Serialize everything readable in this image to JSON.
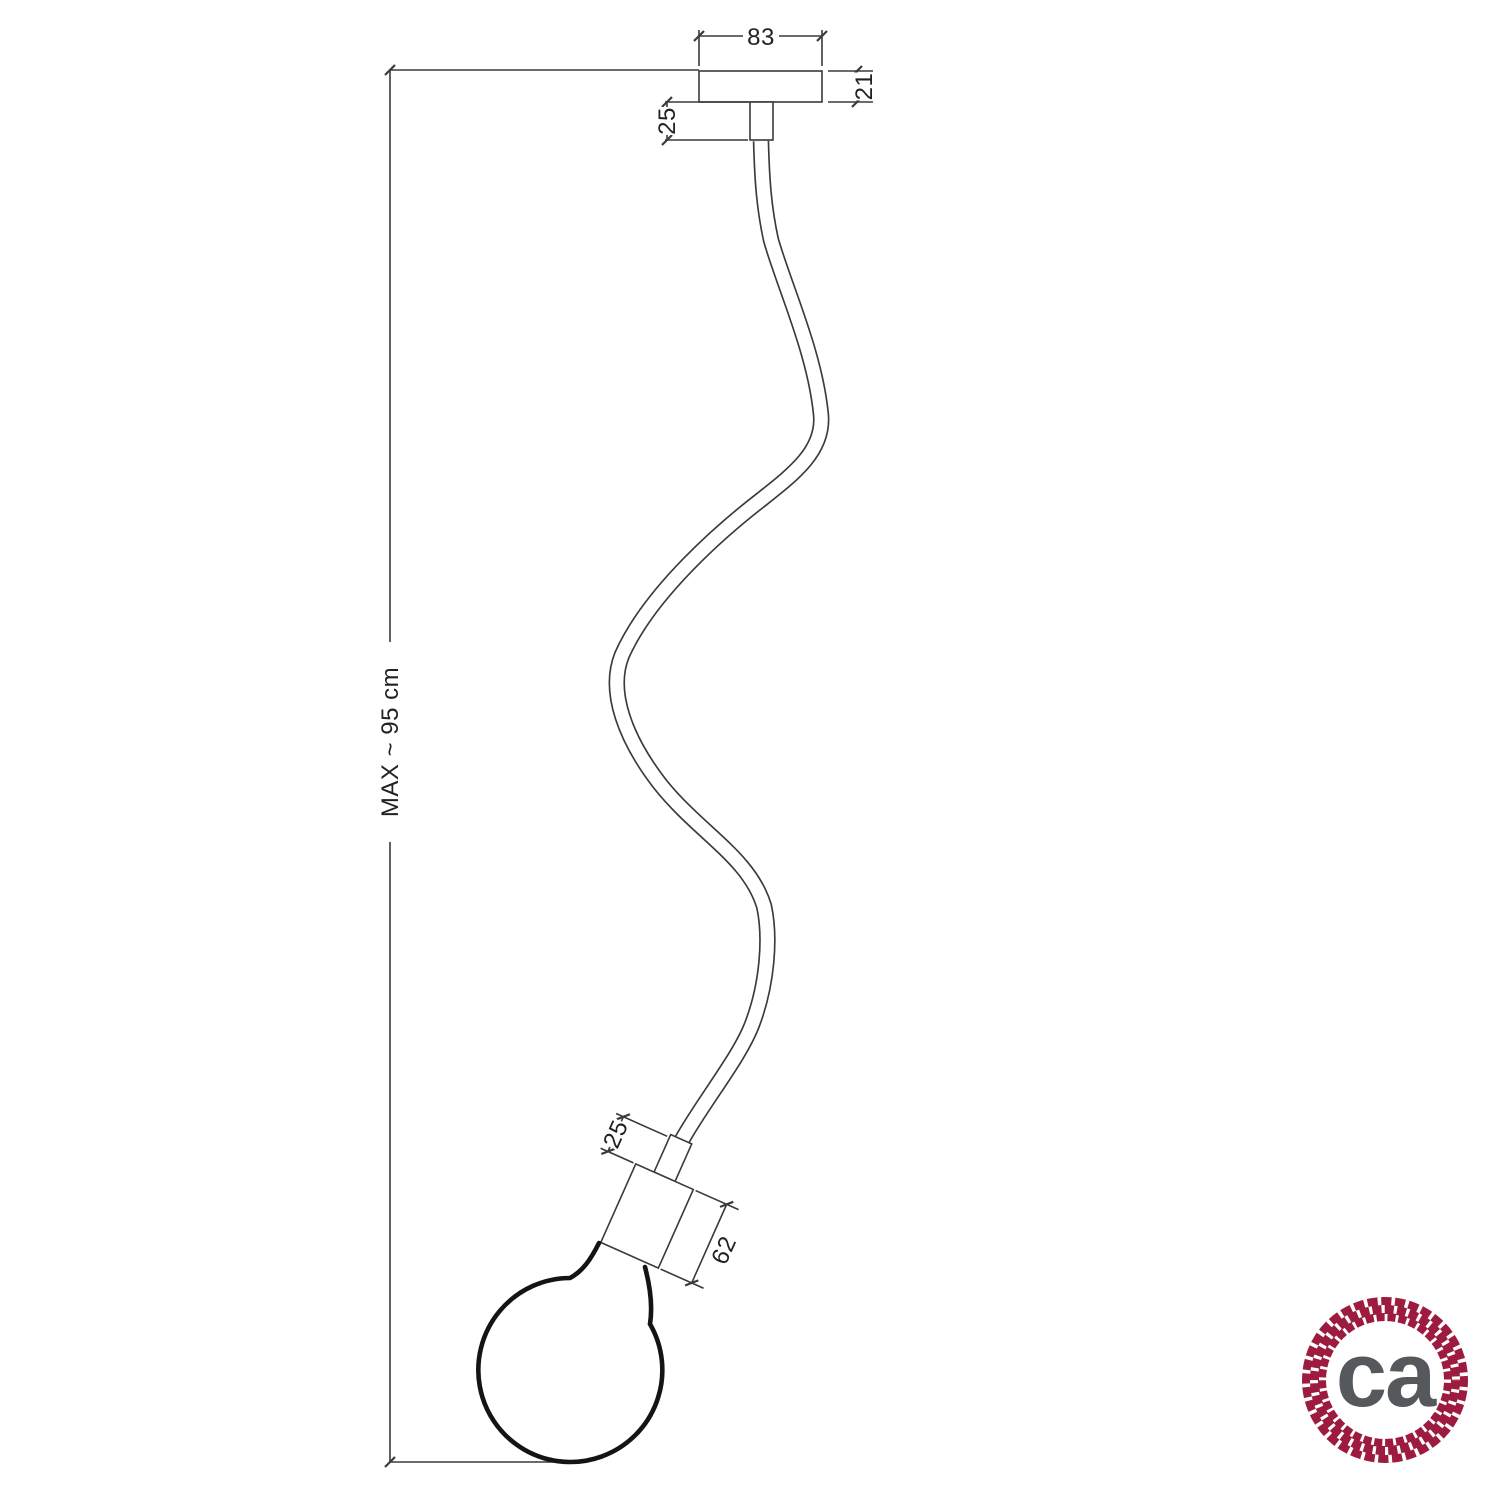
{
  "drawing": {
    "dim_canopy_width": "83",
    "dim_canopy_height": "21",
    "dim_top_nipple": "25",
    "dim_max_drop": "MAX ~ 95 cm",
    "dim_socket_collar": "25",
    "dim_socket_body": "62"
  },
  "logo": {
    "text": "ca",
    "icon": "rope-circle-icon"
  },
  "colors": {
    "line": "#3a3a3a",
    "bulb_outline": "#141414",
    "logo_ring": "#9D1B3F",
    "logo_text": "#55585C",
    "background": "#ffffff"
  }
}
